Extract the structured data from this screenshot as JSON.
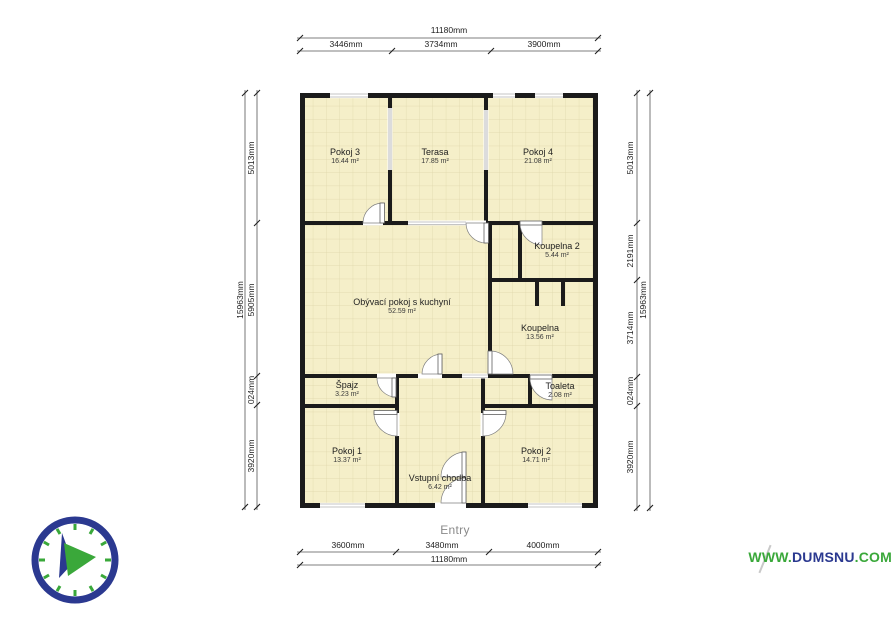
{
  "branding": {
    "watermark_www": "WWW.",
    "watermark_domain": "DUMSNU",
    "watermark_tld": ".COM",
    "green": "#3aa83a",
    "navy": "#2b3990"
  },
  "entry": {
    "label": "Entry"
  },
  "dimensions": {
    "top": {
      "total": "11180mm",
      "segments": [
        "3446mm",
        "3734mm",
        "3900mm"
      ]
    },
    "bottom": {
      "total": "11180mm",
      "segments": [
        "3600mm",
        "3480mm",
        "4000mm"
      ]
    },
    "left": {
      "total": "15963mm",
      "segments": [
        "5013mm",
        "5905mm",
        "024mm",
        "3920mm"
      ]
    },
    "right": {
      "total": "15963mm",
      "segments": [
        "5013mm",
        "2191mm",
        "3714mm",
        "024mm",
        "3920mm"
      ]
    }
  },
  "rooms": [
    {
      "name": "Pokoj 3",
      "area": "16.44 m²"
    },
    {
      "name": "Terasa",
      "area": "17.85 m²"
    },
    {
      "name": "Pokoj 4",
      "area": "21.08 m²"
    },
    {
      "name": "Obývací pokoj s kuchyní",
      "area": "52.59 m²"
    },
    {
      "name": "Koupelna 2",
      "area": "5.44 m²"
    },
    {
      "name": "Koupelna",
      "area": "13.56 m²"
    },
    {
      "name": "Špajz",
      "area": "3.23 m²"
    },
    {
      "name": "Toaleta",
      "area": "2.08 m²"
    },
    {
      "name": "Pokoj 1",
      "area": "13.37 m²"
    },
    {
      "name": "Pokoj 2",
      "area": "14.71 m²"
    },
    {
      "name": "Vstupní chodba",
      "area": "6.42 m²"
    }
  ]
}
